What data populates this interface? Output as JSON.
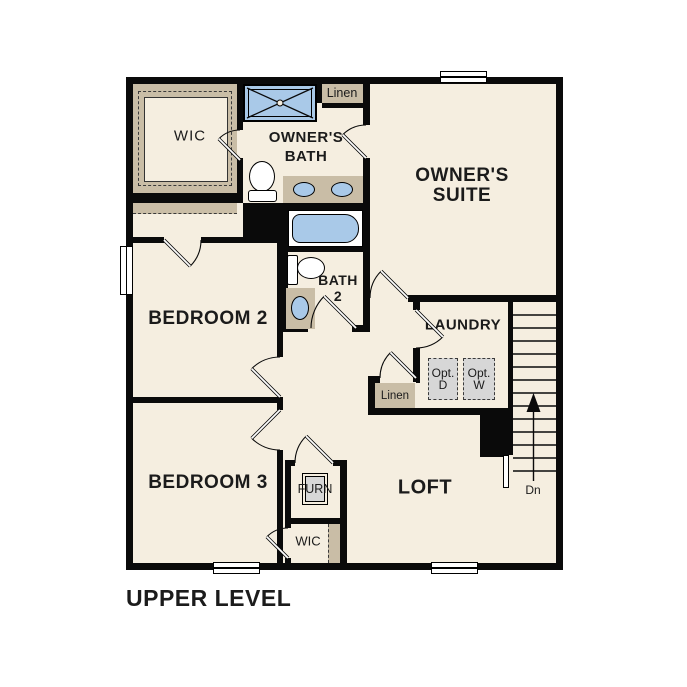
{
  "title": "UPPER LEVEL",
  "colors": {
    "floor": "#f5eee0",
    "tan": "#c9bda6",
    "blue": "#a9c9e8",
    "gray": "#d7d7d7",
    "wall": "#0a0a0a",
    "text": "#1b1b1b"
  },
  "rooms": {
    "wic_top": {
      "label": "WIC"
    },
    "owners_bath": {
      "line1": "OWNER'S",
      "line2": "BATH"
    },
    "linen_top": {
      "label": "Linen"
    },
    "owners_suite": {
      "line1": "OWNER'S",
      "line2": "SUITE"
    },
    "bedroom2": {
      "label": "BEDROOM 2"
    },
    "bath2": {
      "line1": "BATH",
      "line2": "2"
    },
    "laundry": {
      "label": "LAUNDRY"
    },
    "opt_dryer": {
      "line1": "Opt.",
      "line2": "D"
    },
    "opt_washer": {
      "line1": "Opt.",
      "line2": "W"
    },
    "linen_hall": {
      "label": "Linen"
    },
    "bedroom3": {
      "label": "BEDROOM 3"
    },
    "furnace": {
      "label": "FURN"
    },
    "wic_bottom": {
      "label": "WIC"
    },
    "loft": {
      "label": "LOFT"
    },
    "stairs_direction": {
      "label": "Dn"
    }
  }
}
